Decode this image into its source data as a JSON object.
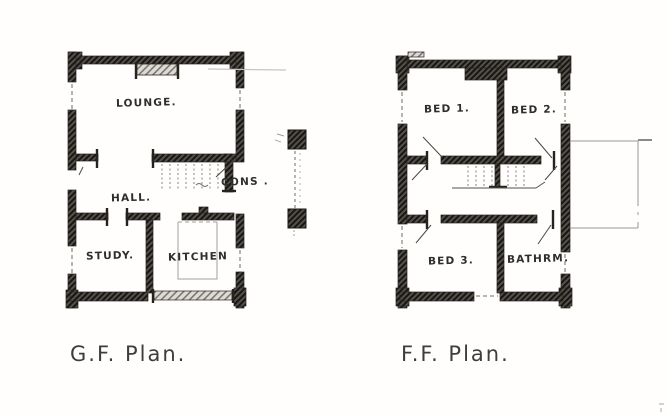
{
  "page": {
    "kind": "scanned hand-drawn floor plan",
    "ink_color": "#2b2b2b",
    "paper_color": "#fffefd"
  },
  "plans": [
    {
      "id": "gf",
      "title": "G.F. Plan.",
      "rooms": [
        {
          "name": "lounge",
          "label": "LOUNGE."
        },
        {
          "name": "conservatory",
          "label": "CONS ."
        },
        {
          "name": "hall",
          "label": "HALL."
        },
        {
          "name": "study",
          "label": "STUDY."
        },
        {
          "name": "kitchen",
          "label": "KITCHEN"
        }
      ]
    },
    {
      "id": "ff",
      "title": "F.F. Plan.",
      "rooms": [
        {
          "name": "bed1",
          "label": "BED 1."
        },
        {
          "name": "bed2",
          "label": "BED 2."
        },
        {
          "name": "bed3",
          "label": "BED 3."
        },
        {
          "name": "bathroom",
          "label": "BATHRM."
        }
      ]
    }
  ]
}
